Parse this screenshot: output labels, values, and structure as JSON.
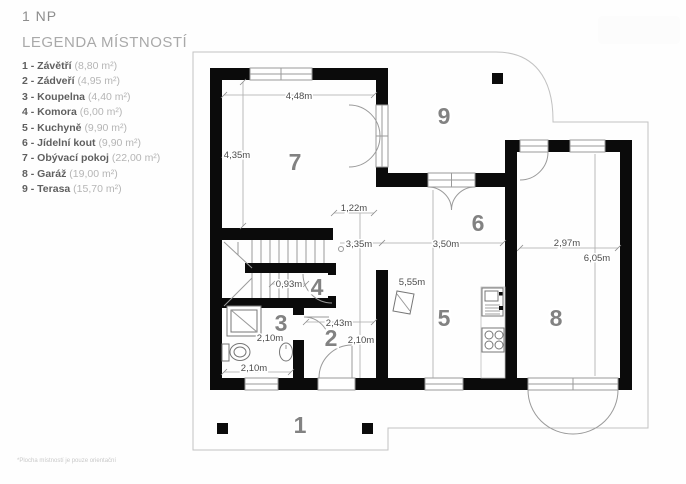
{
  "page": {
    "title": "1 NP"
  },
  "legend": {
    "title": "LEGENDA MÍSTNOSTÍ",
    "items": [
      {
        "label": "1 - Závětří",
        "area": "(8,80 m²)"
      },
      {
        "label": "2 - Zádveří",
        "area": "(4,95 m²)"
      },
      {
        "label": "3 - Koupelna",
        "area": "(4,40 m²)"
      },
      {
        "label": "4 - Komora",
        "area": "(6,00 m²)"
      },
      {
        "label": "5 - Kuchyně",
        "area": "(9,90 m²)"
      },
      {
        "label": "6 - Jídelní kout",
        "area": "(9,90 m²)"
      },
      {
        "label": "7 - Obývací pokoj",
        "area": "(22,00 m²)"
      },
      {
        "label": "8 - Garáž",
        "area": "(19,00 m²)"
      },
      {
        "label": "9 - Terasa",
        "area": "(15,70 m²)"
      }
    ]
  },
  "footnote": "*Plocha místností je pouze orientační",
  "plan": {
    "rooms": [
      {
        "num": "1"
      },
      {
        "num": "2"
      },
      {
        "num": "3"
      },
      {
        "num": "4"
      },
      {
        "num": "5"
      },
      {
        "num": "6"
      },
      {
        "num": "7"
      },
      {
        "num": "8"
      },
      {
        "num": "9"
      }
    ],
    "dims": [
      {
        "label": "4,48m"
      },
      {
        "label": "4,35m"
      },
      {
        "label": "1,22m"
      },
      {
        "label": "3,35m"
      },
      {
        "label": "3,50m"
      },
      {
        "label": "5,55m"
      },
      {
        "label": "2,97m"
      },
      {
        "label": "6,05m"
      },
      {
        "label": "0,93m"
      },
      {
        "label": "2,43m"
      },
      {
        "label": "2,10m"
      },
      {
        "label": "2,10m"
      },
      {
        "label": "2,10m"
      }
    ]
  }
}
